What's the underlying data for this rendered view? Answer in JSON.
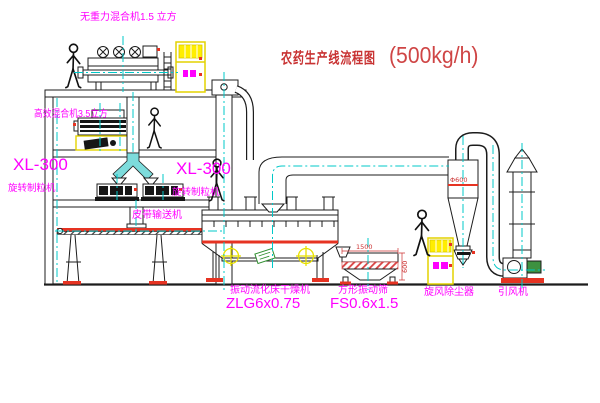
{
  "title": {
    "name": "农药生产线流程图",
    "capacity": "(500kg/h)"
  },
  "equipment": {
    "gravity_free_mixer": {
      "label": "无重力混合机1.5 立方"
    },
    "high_efficiency_mixer": {
      "label": "高效混合机3.5立方"
    },
    "granulator_left": {
      "model": "XL-300",
      "name": "旋转制粒机"
    },
    "granulator_right": {
      "model": "XL-300",
      "name": "旋转制粒机"
    },
    "belt_conveyor": {
      "label": "皮带输送机"
    },
    "fluid_bed_dryer": {
      "name": "振动流化床干燥机",
      "model": "ZLG6x0.75"
    },
    "square_vibrating_sieve": {
      "name": "方形振动筛",
      "model": "FS0.6x1.5",
      "dim_length": "1500",
      "dim_width": "600"
    },
    "cyclone": {
      "name": "旋风除尘器",
      "dim": "Φ600"
    },
    "induced_draft_fan": {
      "name": "引风机"
    }
  },
  "colors": {
    "label_magenta": "#ff00ff",
    "title_red": "#c83232",
    "centerline_cyan": "#00c8c8",
    "cabinet_yellow": "#ffee00",
    "accent_red": "#e63322",
    "motor_green": "#2f8f2f",
    "line_black": "#1c1c1c"
  }
}
